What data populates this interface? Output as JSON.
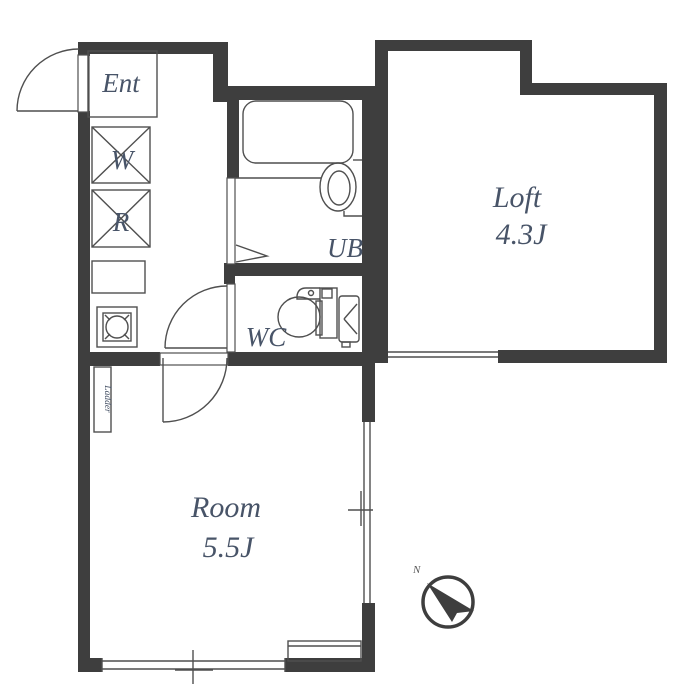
{
  "plan": {
    "type": "apartment-floor-plan",
    "rooms": {
      "entrance": {
        "label": "Ent"
      },
      "washer": {
        "label": "W"
      },
      "fridge": {
        "label": "R"
      },
      "bath": {
        "label": "UB"
      },
      "toilet": {
        "label": "WC"
      },
      "loft": {
        "label": "Loft",
        "size": "4.3J"
      },
      "room": {
        "label": "Room",
        "size": "5.5J"
      }
    },
    "fixtures": {
      "ladder": {
        "label": "Ladder"
      }
    },
    "compass": {
      "north_label": "N"
    },
    "colors": {
      "wall": "#3e3e3e",
      "line": "#4f4f4f",
      "text": "#485468",
      "background": "#ffffff"
    }
  }
}
